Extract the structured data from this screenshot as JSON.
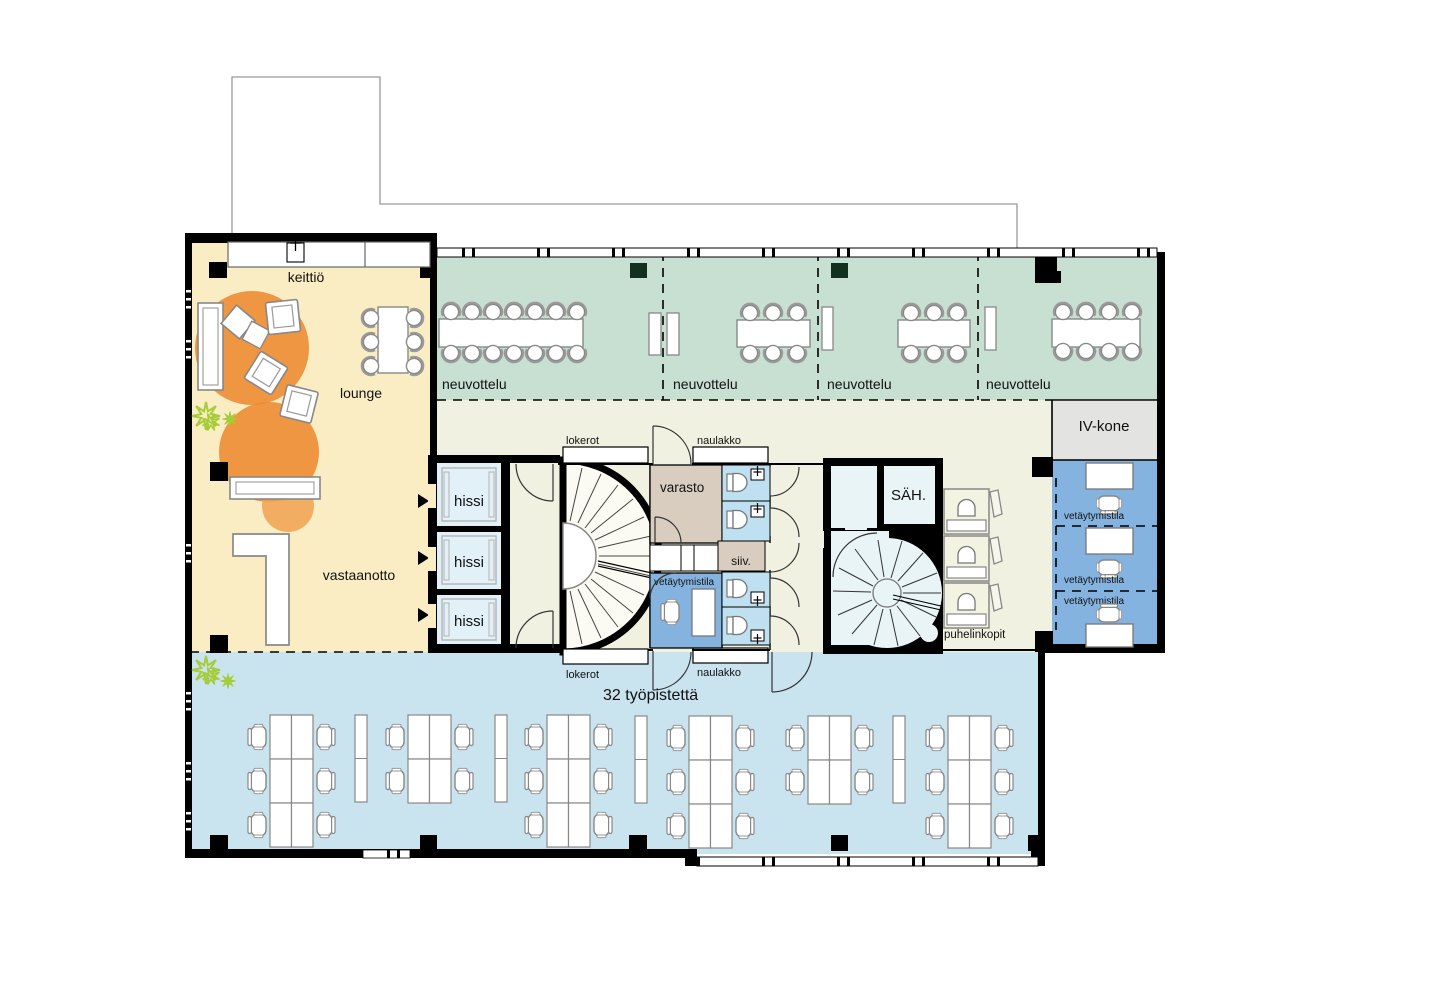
{
  "rooms": {
    "kitchen": "keittiö",
    "lounge": "lounge",
    "reception": "vastaanotto",
    "meeting": [
      "neuvottelu",
      "neuvottelu",
      "neuvottelu",
      "neuvottelu"
    ],
    "elevator": [
      "hissi",
      "hissi",
      "hissi"
    ],
    "lockers_top": "lokerot",
    "lockers_bottom": "lokerot",
    "coat_rack_top": "naulakko",
    "coat_rack_bottom": "naulakko",
    "storage": "varasto",
    "cleaning": "siiv.",
    "electrical": "SÄH.",
    "phone_booths": "puhelinkopit",
    "hvac": "IV-kone",
    "focus_center": "vetäytymistila",
    "focus_right": [
      "vetäytymistila",
      "vetäytymistila",
      "vetäytymistila"
    ],
    "open_office": "32 työpistettä"
  },
  "colors": {
    "zone_lounge": "#FAEDC4",
    "zone_meeting": "#C7E0D2",
    "zone_core": "#F1F1E1",
    "zone_open_office": "#C9E3EF",
    "zone_focus_room": "#85B3E0",
    "zone_wc": "#BEE0F0",
    "zone_storage": "#D9CDC0",
    "zone_hvac": "#E3E3E2",
    "zone_elevator": "#E2F0F7",
    "accent_orange": "#F1953E",
    "accent_plant": "#A5CC39",
    "wall": "#000000"
  }
}
